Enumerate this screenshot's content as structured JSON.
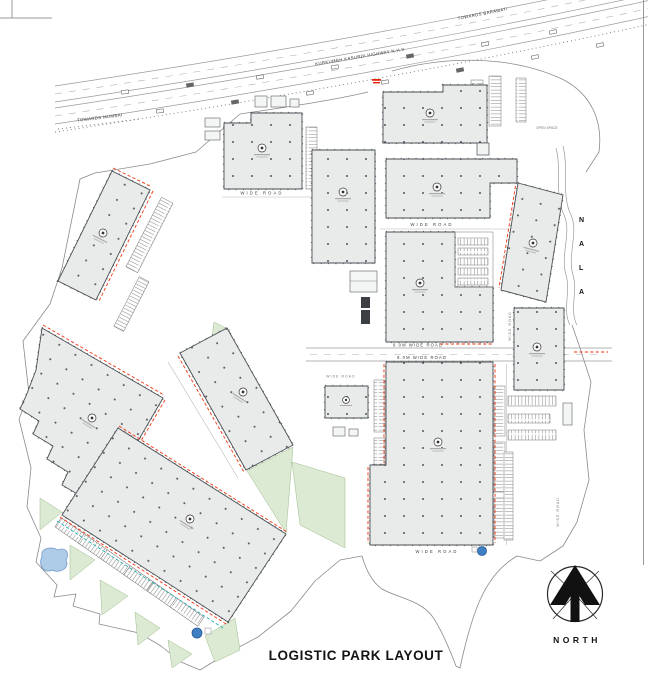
{
  "title": "LOGISTIC PARK LAYOUT",
  "north_label": "NORTH",
  "nala": {
    "letters": [
      "N",
      "A",
      "L",
      "A"
    ]
  },
  "highway": {
    "name": "KURKUMBH KASURDI HIGHWAY N.H.9",
    "towards_west": "TOWARDS MUMBAI",
    "towards_east": "TOWARDS BARAMATI"
  },
  "roads": {
    "main_top": "9.0M WIDE ROAD",
    "main_bottom": "9.0M WIDE ROAD",
    "north_road": "WIDE ROAD",
    "b2_road": "WIDE ROAD",
    "south_road": "WIDE ROAD",
    "west_small": "WIDE ROAD",
    "east_v1": "WIDE ROAD",
    "east_v2": "WIDE ROAD"
  },
  "annotations": {
    "open_space": "OPEN SPACE"
  },
  "icons": [
    "north-arrow-icon",
    "building-label-icon",
    "vehicle-icon",
    "gate-marker"
  ],
  "colors": {
    "building_fill": "#e9ebea",
    "building_outline": "#4a4f54",
    "dock_red": "#f2330f",
    "dock_teal": "#1fb0ad",
    "green_area": "#dcead3",
    "pond_fill": "#aecbe8",
    "water_tank": "#3f7fc4",
    "road_line": "#9a9a9a"
  }
}
